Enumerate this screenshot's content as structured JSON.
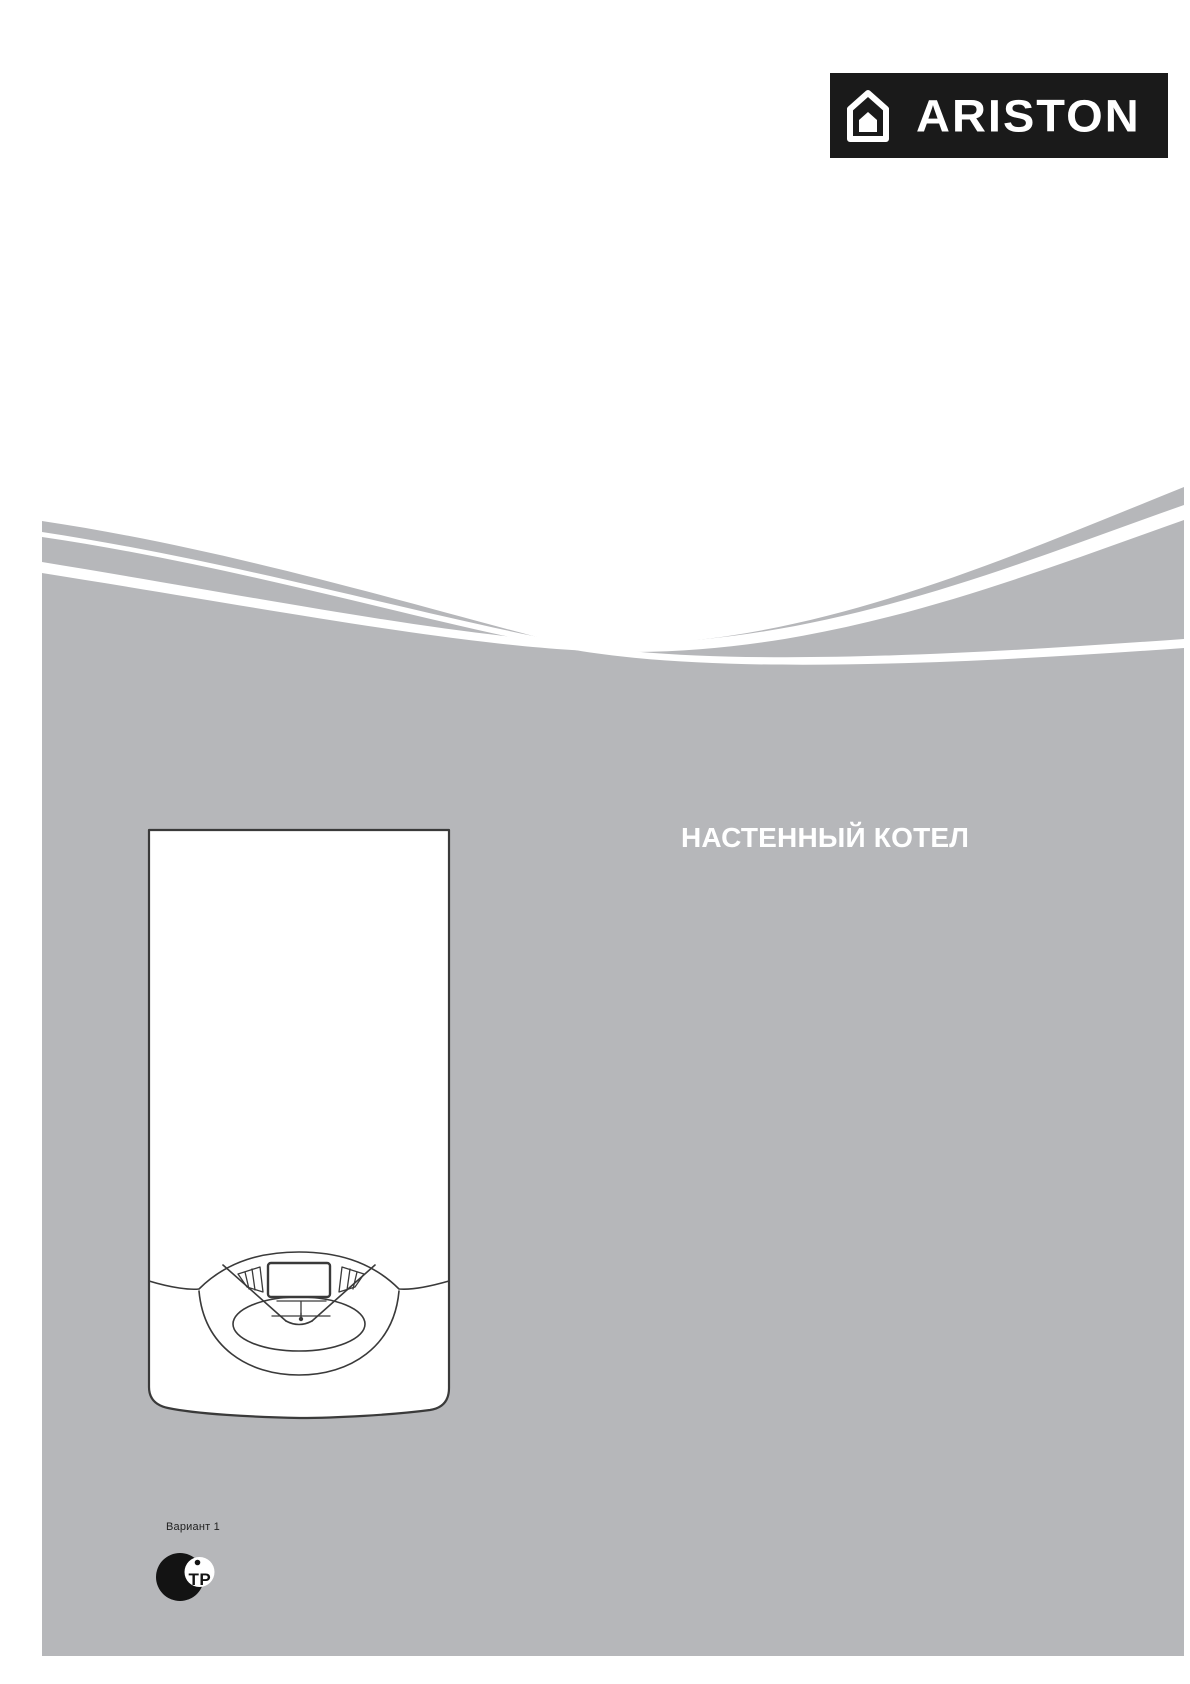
{
  "logo": {
    "brand": "ARISTON",
    "icon": "house-icon",
    "bg_color": "#1a1a1a",
    "text_color": "#ffffff"
  },
  "hero": {
    "title": "НАСТЕННЫЙ КОТЕЛ",
    "title_color": "#ffffff",
    "background_color": "#b6b7ba",
    "wave_accent_color": "#ffffff"
  },
  "illustration": {
    "name": "wall-mounted-boiler-line-drawing",
    "outline_color": "#3a3a3a",
    "body_color": "#ffffff"
  },
  "footer": {
    "variant_label": "Вариант 1",
    "cert_mark": {
      "letters": "ТР",
      "color": "#131313"
    }
  }
}
